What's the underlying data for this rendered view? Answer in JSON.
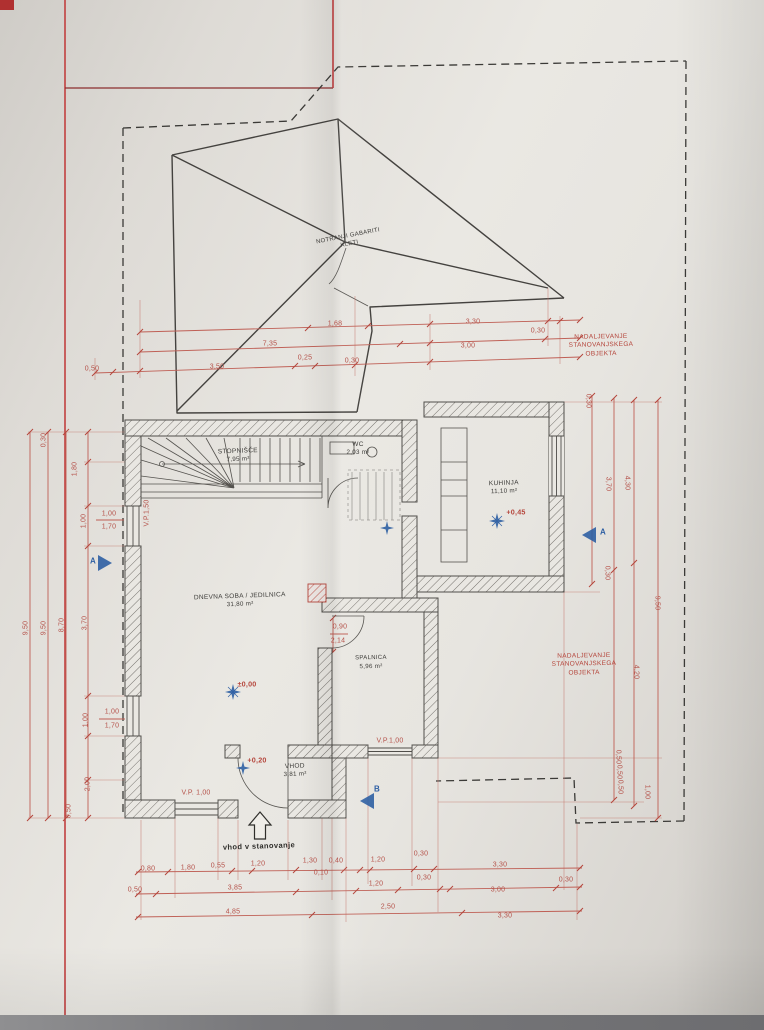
{
  "colors": {
    "paper": "#eae8e3",
    "ink": "#44423f",
    "red": "#c14040",
    "dim": "#b5524a",
    "blue": "#2e5fa3"
  },
  "annotations": {
    "roof_label": "NOTRANJI GABARITI KLETI",
    "continuation": "NADALJEVANJE STANOVANJSKEGA OBJEKTA",
    "entrance": "vhod v stanovanje"
  },
  "rooms": {
    "stairs": {
      "name": "STOPNIŠČE",
      "area": "7,95 m²"
    },
    "wc": {
      "name": "WC",
      "area": "2,03 m²"
    },
    "kitchen": {
      "name": "KUHINJA",
      "area": "11,10 m²"
    },
    "living": {
      "name": "DNEVNA SOBA / JEDILNICA",
      "area": "31,80 m²"
    },
    "bedroom": {
      "name": "SPALNICA",
      "area": "5,96 m²"
    },
    "entry": {
      "name": "VHOD",
      "area": "3,81 m²"
    }
  },
  "dimension_labels": [
    {
      "t": "0,80",
      "x": 148,
      "y": 869
    },
    {
      "t": "1,80",
      "x": 188,
      "y": 868
    },
    {
      "t": "0,55",
      "x": 218,
      "y": 866
    },
    {
      "t": "1,20",
      "x": 258,
      "y": 864
    },
    {
      "t": "1,30",
      "x": 310,
      "y": 861
    },
    {
      "t": "0,40",
      "x": 336,
      "y": 861
    },
    {
      "t": "0,10",
      "x": 321,
      "y": 873
    },
    {
      "t": "1,20",
      "x": 378,
      "y": 860
    },
    {
      "t": "0,30",
      "x": 421,
      "y": 854
    },
    {
      "t": "3,30",
      "x": 500,
      "y": 865
    },
    {
      "t": "0,30",
      "x": 566,
      "y": 880
    },
    {
      "t": "0,50",
      "x": 135,
      "y": 890
    },
    {
      "t": "3,85",
      "x": 235,
      "y": 888
    },
    {
      "t": "1,20",
      "x": 376,
      "y": 884
    },
    {
      "t": "0,30",
      "x": 424,
      "y": 878
    },
    {
      "t": "3,00",
      "x": 498,
      "y": 890
    },
    {
      "t": "4,85",
      "x": 233,
      "y": 912
    },
    {
      "t": "2,50",
      "x": 388,
      "y": 907
    },
    {
      "t": "3,30",
      "x": 505,
      "y": 916
    },
    {
      "t": "1,68",
      "x": 335,
      "y": 324
    },
    {
      "t": "3,30",
      "x": 473,
      "y": 322
    },
    {
      "t": "0,30",
      "x": 538,
      "y": 331
    },
    {
      "t": "7,35",
      "x": 270,
      "y": 344
    },
    {
      "t": "3,00",
      "x": 468,
      "y": 346
    },
    {
      "t": "0,25",
      "x": 305,
      "y": 358
    },
    {
      "t": "0,30",
      "x": 352,
      "y": 361
    },
    {
      "t": "3,50",
      "x": 217,
      "y": 367
    },
    {
      "t": "0,50",
      "x": 92,
      "y": 369
    },
    {
      "t": "0,30",
      "x": 44,
      "y": 440,
      "r": -90
    },
    {
      "t": "1,80",
      "x": 75,
      "y": 469,
      "r": -90
    },
    {
      "t": "1,00",
      "x": 84,
      "y": 521,
      "r": -90
    },
    {
      "t": "9,50",
      "x": 26,
      "y": 628,
      "r": -90
    },
    {
      "t": "9,50",
      "x": 44,
      "y": 628,
      "r": -90
    },
    {
      "t": "8,70",
      "x": 62,
      "y": 625,
      "r": -90
    },
    {
      "t": "3,70",
      "x": 85,
      "y": 623,
      "r": -90
    },
    {
      "t": "1,00",
      "x": 86,
      "y": 720,
      "r": -90
    },
    {
      "t": "2,00",
      "x": 88,
      "y": 784,
      "r": -90
    },
    {
      "t": "0,50",
      "x": 69,
      "y": 811,
      "r": -90
    },
    {
      "t": "1,00",
      "x": 109,
      "y": 514
    },
    {
      "t": "1,70",
      "x": 109,
      "y": 527
    },
    {
      "t": "1,00",
      "x": 112,
      "y": 712
    },
    {
      "t": "1,70",
      "x": 112,
      "y": 726
    },
    {
      "t": "V.P.1,50",
      "x": 147,
      "y": 513,
      "r": -90
    },
    {
      "t": "V.P. 1,00",
      "x": 196,
      "y": 793
    },
    {
      "t": "V.P.1,00",
      "x": 390,
      "y": 741
    },
    {
      "t": "0,90",
      "x": 340,
      "y": 627
    },
    {
      "t": "2,14",
      "x": 338,
      "y": 641
    },
    {
      "t": "0,30",
      "x": 588,
      "y": 401,
      "r": 90
    },
    {
      "t": "3,70",
      "x": 608,
      "y": 484,
      "r": 90
    },
    {
      "t": "4,30",
      "x": 627,
      "y": 483,
      "r": 90
    },
    {
      "t": "0,30",
      "x": 607,
      "y": 573,
      "r": 90
    },
    {
      "t": "9,50",
      "x": 657,
      "y": 603,
      "r": 90
    },
    {
      "t": "4,20",
      "x": 636,
      "y": 672,
      "r": 90
    },
    {
      "t": "0,50",
      "x": 618,
      "y": 757,
      "r": 90
    },
    {
      "t": "0,50",
      "x": 619,
      "y": 772,
      "r": 90
    },
    {
      "t": "0,50",
      "x": 620,
      "y": 787,
      "r": 90
    },
    {
      "t": "1,00",
      "x": 647,
      "y": 792,
      "r": 90
    },
    {
      "t": "±0,00",
      "x": 247,
      "y": 684,
      "c": "level"
    },
    {
      "t": "+0,45",
      "x": 516,
      "y": 512,
      "c": "level"
    },
    {
      "t": "+0,20",
      "x": 257,
      "y": 760,
      "c": "level"
    },
    {
      "t": "A",
      "x": 93,
      "y": 561,
      "c": "blue"
    },
    {
      "t": "A",
      "x": 603,
      "y": 532,
      "c": "blue"
    },
    {
      "t": "B",
      "x": 377,
      "y": 789,
      "c": "blue"
    }
  ]
}
